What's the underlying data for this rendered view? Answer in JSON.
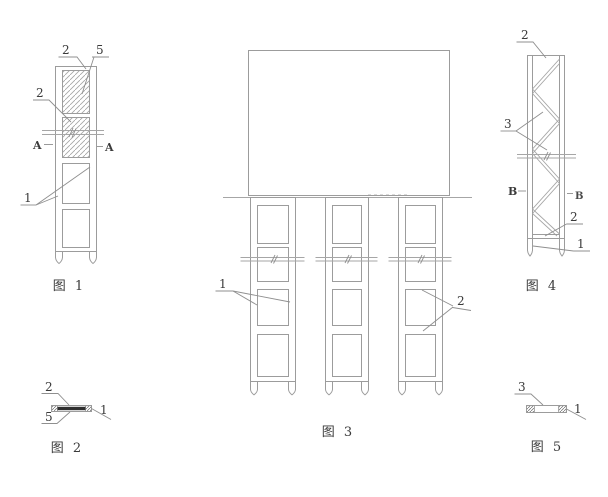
{
  "page": {
    "background": "#ffffff"
  },
  "palette": {
    "line": "#9c9c9c",
    "dark_fill": "#2f2f2f",
    "text": "#3a3a3a"
  },
  "figures": {
    "fig1": {
      "caption": "图 1",
      "label_top_left": "2",
      "label_top_right": "5",
      "label_mid": "2",
      "label_lower": "1",
      "section_left": "A",
      "section_right": "A"
    },
    "fig2": {
      "caption": "图 2",
      "label_top": "2",
      "label_bottom": "5",
      "label_right": "1"
    },
    "fig3": {
      "caption": "图 3",
      "label_left": "1",
      "label_right": "2"
    },
    "fig4": {
      "caption": "图 4",
      "label_top": "2",
      "label_mid": "3",
      "label_lower": "2",
      "label_bottom": "1",
      "section_left": "B",
      "section_right": "B"
    },
    "fig5": {
      "caption": "图 5",
      "label_top": "3",
      "label_right": "1"
    }
  }
}
